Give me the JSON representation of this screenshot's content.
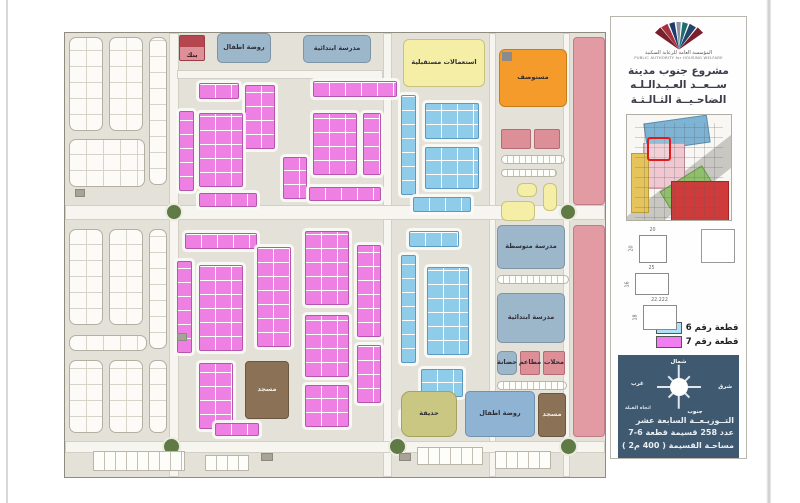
{
  "sidebar": {
    "org_name_ar": "المؤسسة العامة للرعاية السكنية",
    "org_name_en": "PUBLIC AUTHORITY for HOUSING WELFARE",
    "title_lines": [
      "مشروع جنوب مدينة",
      "ســعــد العـبـدالـلـه",
      "الضاحـيــة الثـالـثـة"
    ],
    "plot_diagrams": [
      {
        "top": "20",
        "side": "20"
      },
      {
        "top": "25",
        "side": "16"
      },
      {
        "top": "22.222",
        "side": "18"
      }
    ],
    "legend": [
      {
        "label": "قطعة رقم 6",
        "color": "#aee1f4"
      },
      {
        "label": "قطعة رقم 7",
        "color": "#f07ef0"
      }
    ],
    "compass": {
      "north": "شمال",
      "south": "جنوب",
      "east": "شرق",
      "west": "غرب",
      "qibla": "اتجاه القبلة"
    },
    "info_lines": [
      "التــوزيـعــة السابعة عشر",
      "عدد 258 قسيمة قطعة 6-7",
      "مساحـة القسيمة ( 400 م2 )"
    ]
  },
  "map": {
    "colors": {
      "plot6": "#8fccea",
      "plot7": "#ee80e4",
      "school": "#9cb6ca",
      "clinic": "#f59b2c",
      "future_use": "#f4eea6",
      "mosque": "#8b7257",
      "park": "#cac783",
      "adjacent_zone": "#e29aa3",
      "roundabout": "#5f7a45"
    },
    "elements": [
      {
        "t": "road-v",
        "n": "road",
        "x": 104,
        "y": 0,
        "w": 10,
        "h": 444
      },
      {
        "t": "road-v",
        "n": "road",
        "x": 318,
        "y": 0,
        "w": 9,
        "h": 444
      },
      {
        "t": "road-v",
        "n": "road",
        "x": 424,
        "y": 0,
        "w": 7,
        "h": 444
      },
      {
        "t": "road-v",
        "n": "road",
        "x": 498,
        "y": 0,
        "w": 7,
        "h": 444
      },
      {
        "t": "road-h",
        "n": "road",
        "x": 0,
        "y": 172,
        "w": 540,
        "h": 15
      },
      {
        "t": "road-h",
        "n": "road",
        "x": 0,
        "y": 408,
        "w": 540,
        "h": 12
      },
      {
        "t": "road-h",
        "n": "road",
        "x": 112,
        "y": 37,
        "w": 206,
        "h": 9
      },
      {
        "t": "grid",
        "n": "residential-block",
        "x": 4,
        "y": 4,
        "w": 34,
        "h": 94
      },
      {
        "t": "grid",
        "n": "residential-block",
        "x": 44,
        "y": 4,
        "w": 34,
        "h": 94
      },
      {
        "t": "grid",
        "n": "residential-block",
        "x": 84,
        "y": 4,
        "w": 18,
        "h": 148
      },
      {
        "t": "grid",
        "n": "residential-block",
        "x": 4,
        "y": 106,
        "w": 76,
        "h": 48
      },
      {
        "t": "grid",
        "n": "residential-block",
        "x": 4,
        "y": 196,
        "w": 34,
        "h": 96
      },
      {
        "t": "grid",
        "n": "residential-block",
        "x": 44,
        "y": 196,
        "w": 34,
        "h": 96
      },
      {
        "t": "grid",
        "n": "residential-block",
        "x": 84,
        "y": 196,
        "w": 18,
        "h": 120
      },
      {
        "t": "grid",
        "n": "residential-block",
        "x": 4,
        "y": 302,
        "w": 78,
        "h": 16
      },
      {
        "t": "grid",
        "n": "residential-block",
        "x": 4,
        "y": 327,
        "w": 34,
        "h": 73
      },
      {
        "t": "grid",
        "n": "residential-block",
        "x": 44,
        "y": 327,
        "w": 34,
        "h": 73
      },
      {
        "t": "grid",
        "n": "residential-block",
        "x": 84,
        "y": 327,
        "w": 18,
        "h": 73
      },
      {
        "t": "bank",
        "n": "bank-block",
        "x": 114,
        "y": 2,
        "w": 26,
        "h": 26,
        "label": "بنك"
      },
      {
        "t": "school",
        "n": "kindergarten-block",
        "x": 152,
        "y": 0,
        "w": 54,
        "h": 30,
        "label": "روضة اطفال"
      },
      {
        "t": "school",
        "n": "elementary-school-block",
        "x": 238,
        "y": 2,
        "w": 68,
        "h": 28,
        "label": "مدرسة ابتدائية"
      },
      {
        "t": "future",
        "n": "future-use-block",
        "x": 338,
        "y": 6,
        "w": 82,
        "h": 48,
        "label": "استعمالات مستقبلية"
      },
      {
        "t": "clinic",
        "n": "clinic-block",
        "x": 434,
        "y": 16,
        "w": 68,
        "h": 58,
        "label": "مستوصف"
      },
      {
        "t": "rose",
        "n": "adjacent-zone-block",
        "x": 508,
        "y": 4,
        "w": 32,
        "h": 168
      },
      {
        "t": "rose",
        "n": "adjacent-zone-block",
        "x": 508,
        "y": 192,
        "w": 32,
        "h": 212
      },
      {
        "t": "p7",
        "n": "plot-7-cluster",
        "x": 114,
        "y": 78,
        "w": 15,
        "h": 80
      },
      {
        "t": "p7",
        "n": "plot-7-cluster",
        "x": 134,
        "y": 50,
        "w": 40,
        "h": 16
      },
      {
        "t": "p7",
        "n": "plot-7-cluster",
        "x": 180,
        "y": 52,
        "w": 30,
        "h": 64
      },
      {
        "t": "p7",
        "n": "plot-7-cluster",
        "x": 134,
        "y": 80,
        "w": 44,
        "h": 74
      },
      {
        "t": "p7",
        "n": "plot-7-cluster",
        "x": 248,
        "y": 48,
        "w": 84,
        "h": 16
      },
      {
        "t": "p7",
        "n": "plot-7-cluster",
        "x": 248,
        "y": 80,
        "w": 44,
        "h": 62
      },
      {
        "t": "p7",
        "n": "plot-7-cluster",
        "x": 298,
        "y": 80,
        "w": 18,
        "h": 62
      },
      {
        "t": "p7",
        "n": "plot-7-cluster",
        "x": 218,
        "y": 124,
        "w": 24,
        "h": 42
      },
      {
        "t": "p7",
        "n": "plot-7-cluster",
        "x": 134,
        "y": 160,
        "w": 58,
        "h": 14
      },
      {
        "t": "p7",
        "n": "plot-7-cluster",
        "x": 244,
        "y": 154,
        "w": 72,
        "h": 14
      },
      {
        "t": "p7",
        "n": "plot-7-cluster",
        "x": 120,
        "y": 200,
        "w": 72,
        "h": 16
      },
      {
        "t": "p7",
        "n": "plot-7-cluster",
        "x": 112,
        "y": 228,
        "w": 15,
        "h": 92
      },
      {
        "t": "p7",
        "n": "plot-7-cluster",
        "x": 134,
        "y": 232,
        "w": 44,
        "h": 86
      },
      {
        "t": "p7",
        "n": "plot-7-cluster",
        "x": 192,
        "y": 214,
        "w": 34,
        "h": 100
      },
      {
        "t": "p7",
        "n": "plot-7-cluster",
        "x": 240,
        "y": 198,
        "w": 44,
        "h": 74
      },
      {
        "t": "p7",
        "n": "plot-7-cluster",
        "x": 240,
        "y": 282,
        "w": 44,
        "h": 62
      },
      {
        "t": "p7",
        "n": "plot-7-cluster",
        "x": 292,
        "y": 212,
        "w": 24,
        "h": 92
      },
      {
        "t": "p7",
        "n": "plot-7-cluster",
        "x": 292,
        "y": 312,
        "w": 24,
        "h": 58
      },
      {
        "t": "p7",
        "n": "plot-7-cluster",
        "x": 134,
        "y": 330,
        "w": 34,
        "h": 66
      },
      {
        "t": "p7",
        "n": "plot-7-cluster",
        "x": 240,
        "y": 352,
        "w": 44,
        "h": 42
      },
      {
        "t": "p7",
        "n": "plot-7-cluster",
        "x": 150,
        "y": 390,
        "w": 44,
        "h": 13
      },
      {
        "t": "p6",
        "n": "plot-6-cluster",
        "x": 336,
        "y": 62,
        "w": 15,
        "h": 100
      },
      {
        "t": "p6",
        "n": "plot-6-cluster",
        "x": 360,
        "y": 70,
        "w": 54,
        "h": 36
      },
      {
        "t": "p6",
        "n": "plot-6-cluster",
        "x": 360,
        "y": 114,
        "w": 54,
        "h": 42
      },
      {
        "t": "p6",
        "n": "plot-6-cluster",
        "x": 348,
        "y": 164,
        "w": 58,
        "h": 15
      },
      {
        "t": "p6",
        "n": "plot-6-cluster",
        "x": 344,
        "y": 198,
        "w": 50,
        "h": 16
      },
      {
        "t": "p6",
        "n": "plot-6-cluster",
        "x": 336,
        "y": 222,
        "w": 15,
        "h": 108
      },
      {
        "t": "p6",
        "n": "plot-6-cluster",
        "x": 362,
        "y": 234,
        "w": 42,
        "h": 88
      },
      {
        "t": "p6",
        "n": "plot-6-cluster",
        "x": 356,
        "y": 336,
        "w": 42,
        "h": 28
      },
      {
        "t": "p6",
        "n": "plot-6-cluster",
        "x": 336,
        "y": 378,
        "w": 30,
        "h": 15
      },
      {
        "t": "shops",
        "n": "shops-block",
        "x": 436,
        "y": 96,
        "w": 30,
        "h": 20
      },
      {
        "t": "shops",
        "n": "shops-block",
        "x": 469,
        "y": 96,
        "w": 26,
        "h": 20
      },
      {
        "t": "pill",
        "n": "parking-strip",
        "x": 436,
        "y": 122,
        "w": 64,
        "h": 9
      },
      {
        "t": "pill",
        "n": "parking-strip",
        "x": 436,
        "y": 136,
        "w": 56,
        "h": 8
      },
      {
        "t": "future",
        "n": "service-block",
        "x": 452,
        "y": 150,
        "w": 20,
        "h": 14
      },
      {
        "t": "future",
        "n": "service-block",
        "x": 478,
        "y": 150,
        "w": 14,
        "h": 28
      },
      {
        "t": "future",
        "n": "service-block",
        "x": 436,
        "y": 168,
        "w": 34,
        "h": 20
      },
      {
        "t": "school",
        "n": "middle-school-block",
        "x": 432,
        "y": 192,
        "w": 68,
        "h": 44,
        "label": "مدرسة متوسطة"
      },
      {
        "t": "pill",
        "n": "parking-strip",
        "x": 432,
        "y": 242,
        "w": 72,
        "h": 9
      },
      {
        "t": "school",
        "n": "elementary-school-block",
        "x": 432,
        "y": 260,
        "w": 68,
        "h": 50,
        "label": "مدرسة ابتدائية"
      },
      {
        "t": "school",
        "n": "nursery-block",
        "x": 432,
        "y": 318,
        "w": 20,
        "h": 24,
        "label": "حضانة"
      },
      {
        "t": "shops",
        "n": "restaurants-block",
        "x": 455,
        "y": 318,
        "w": 20,
        "h": 24,
        "label": "مطاعم"
      },
      {
        "t": "shops",
        "n": "shops-block",
        "x": 478,
        "y": 318,
        "w": 22,
        "h": 24,
        "label": "محلات"
      },
      {
        "t": "pill",
        "n": "parking-strip",
        "x": 432,
        "y": 348,
        "w": 70,
        "h": 9
      },
      {
        "t": "mosque",
        "n": "mosque-block",
        "x": 180,
        "y": 328,
        "w": 44,
        "h": 58,
        "label": "مسجد"
      },
      {
        "t": "park",
        "n": "park-block",
        "x": 336,
        "y": 358,
        "w": 56,
        "h": 46,
        "label": "حديقة"
      },
      {
        "t": "kgblue",
        "n": "kindergarten-block",
        "x": 400,
        "y": 358,
        "w": 70,
        "h": 46,
        "label": "روضة اطفال"
      },
      {
        "t": "mosque",
        "n": "mosque-block",
        "x": 473,
        "y": 360,
        "w": 28,
        "h": 44,
        "label": "مسجد"
      },
      {
        "t": "ra",
        "n": "roundabout",
        "x": 100,
        "y": 170,
        "w": 18,
        "h": 18
      },
      {
        "t": "ra",
        "n": "roundabout",
        "x": 494,
        "y": 170,
        "w": 18,
        "h": 18
      },
      {
        "t": "ra",
        "n": "roundabout",
        "x": 97,
        "y": 404,
        "w": 19,
        "h": 19
      },
      {
        "t": "ra",
        "n": "roundabout",
        "x": 323,
        "y": 404,
        "w": 19,
        "h": 19
      },
      {
        "t": "ra",
        "n": "roundabout",
        "x": 494,
        "y": 404,
        "w": 19,
        "h": 19
      },
      {
        "t": "park-cells",
        "n": "parking-strip",
        "x": 28,
        "y": 418,
        "w": 92,
        "h": 20
      },
      {
        "t": "park-cells",
        "n": "parking-strip",
        "x": 140,
        "y": 422,
        "w": 44,
        "h": 16
      },
      {
        "t": "park-cells",
        "n": "parking-strip",
        "x": 352,
        "y": 414,
        "w": 66,
        "h": 18
      },
      {
        "t": "park-cells",
        "n": "parking-strip",
        "x": 430,
        "y": 418,
        "w": 56,
        "h": 18
      },
      {
        "t": "util",
        "n": "utility-box",
        "x": 10,
        "y": 156,
        "w": 10,
        "h": 8
      },
      {
        "t": "util",
        "n": "utility-box",
        "x": 334,
        "y": 420,
        "w": 12,
        "h": 8
      },
      {
        "t": "util",
        "n": "utility-box",
        "x": 112,
        "y": 300,
        "w": 10,
        "h": 8
      },
      {
        "t": "util",
        "n": "utility-box",
        "x": 196,
        "y": 420,
        "w": 12,
        "h": 8
      }
    ]
  }
}
